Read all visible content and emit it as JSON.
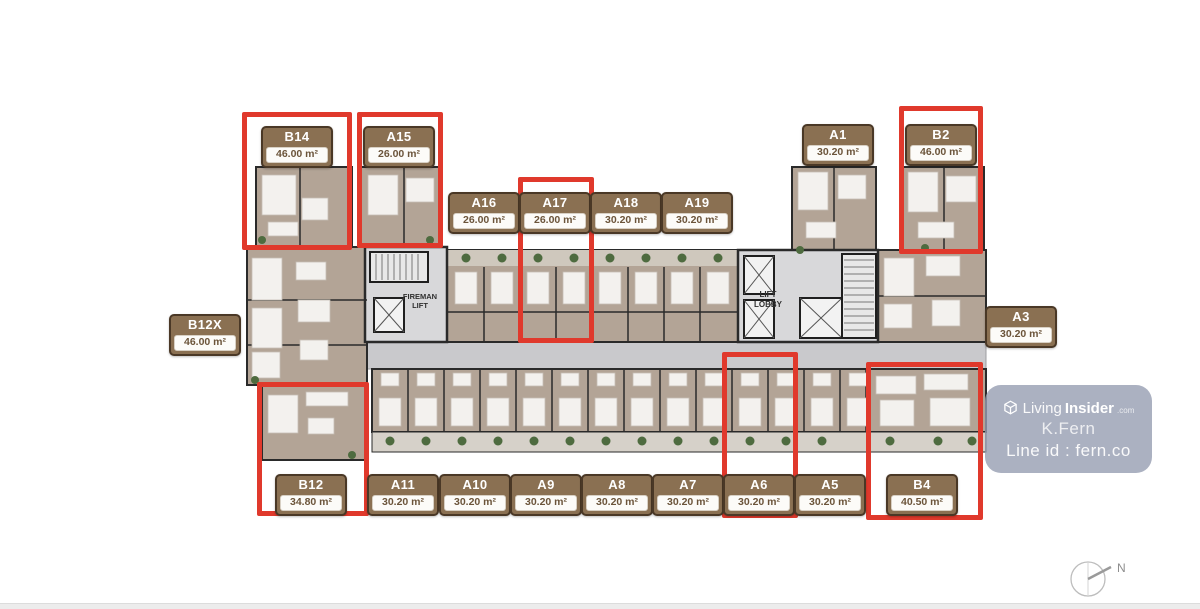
{
  "plan": {
    "fireman_lift": [
      "FIREMAN",
      "LIFT"
    ],
    "lift_lobby": [
      "LIFT",
      "LOBBY"
    ]
  },
  "units": [
    {
      "id": "B14",
      "area": "46.00 m²",
      "bx": 297,
      "by": 126,
      "hl": {
        "x": 242,
        "y": 112,
        "w": 110,
        "h": 138
      }
    },
    {
      "id": "A15",
      "area": "26.00 m²",
      "bx": 399,
      "by": 126,
      "hl": {
        "x": 357,
        "y": 112,
        "w": 86,
        "h": 136
      }
    },
    {
      "id": "A16",
      "area": "26.00 m²",
      "bx": 484,
      "by": 192
    },
    {
      "id": "A17",
      "area": "26.00 m²",
      "bx": 555,
      "by": 192,
      "hl": {
        "x": 518,
        "y": 177,
        "w": 76,
        "h": 166
      }
    },
    {
      "id": "A18",
      "area": "30.20 m²",
      "bx": 626,
      "by": 192
    },
    {
      "id": "A19",
      "area": "30.20 m²",
      "bx": 697,
      "by": 192
    },
    {
      "id": "A1",
      "area": "30.20 m²",
      "bx": 838,
      "by": 124
    },
    {
      "id": "B2",
      "area": "46.00 m²",
      "bx": 941,
      "by": 124,
      "hl": {
        "x": 899,
        "y": 106,
        "w": 84,
        "h": 148
      }
    },
    {
      "id": "B12X",
      "area": "46.00 m²",
      "bx": 205,
      "by": 314
    },
    {
      "id": "A3",
      "area": "30.20 m²",
      "bx": 1021,
      "by": 306
    },
    {
      "id": "B12",
      "area": "34.80 m²",
      "bx": 311,
      "by": 474,
      "hl": {
        "x": 257,
        "y": 382,
        "w": 112,
        "h": 134
      }
    },
    {
      "id": "A11",
      "area": "30.20 m²",
      "bx": 403,
      "by": 474
    },
    {
      "id": "A10",
      "area": "30.20 m²",
      "bx": 475,
      "by": 474
    },
    {
      "id": "A9",
      "area": "30.20 m²",
      "bx": 546,
      "by": 474
    },
    {
      "id": "A8",
      "area": "30.20 m²",
      "bx": 617,
      "by": 474
    },
    {
      "id": "A7",
      "area": "30.20 m²",
      "bx": 688,
      "by": 474
    },
    {
      "id": "A6",
      "area": "30.20 m²",
      "bx": 759,
      "by": 474,
      "hl": {
        "x": 722,
        "y": 352,
        "w": 76,
        "h": 166
      }
    },
    {
      "id": "A5",
      "area": "30.20 m²",
      "bx": 830,
      "by": 474
    },
    {
      "id": "B4",
      "area": "40.50 m²",
      "bx": 922,
      "by": 474,
      "hl": {
        "x": 866,
        "y": 362,
        "w": 117,
        "h": 158
      }
    }
  ],
  "watermark": {
    "brand_light": "Living",
    "brand_bold": "Insider",
    "brand_tld": ".com",
    "line1": "K.Fern",
    "line2": "Line id : fern.co"
  },
  "compass": {
    "north_label": "N"
  },
  "colors": {
    "highlight_red": "#e0392c",
    "badge_brown": "#8a7052",
    "badge_border": "#4a3826",
    "floor_tan": "#b3a496",
    "corridor_gray": "#c9c9cc",
    "wall_dark": "#2a2a2a",
    "plant_green": "#4e6b3f",
    "watermark_bg": "rgba(150,158,177,0.80)"
  }
}
